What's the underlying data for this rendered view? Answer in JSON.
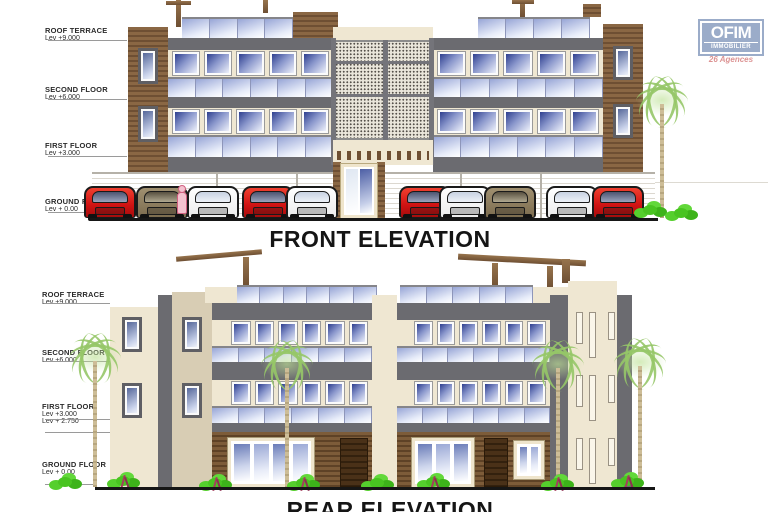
{
  "logo": {
    "name": "OFIM",
    "subtitle": "IMMOBILIER",
    "tagline": "26 Agences"
  },
  "front_elevation": {
    "title": "FRONT ELEVATION",
    "levels": [
      {
        "floor": "ROOF TERRACE",
        "level": "Lev +9.000"
      },
      {
        "floor": "SECOND FLOOR",
        "level": "Lev +6.000"
      },
      {
        "floor": "FIRST FLOOR",
        "level": "Lev +3.000"
      },
      {
        "floor": "GROUND FLOOR",
        "level": "Lev + 0.00"
      }
    ],
    "cars": [
      {
        "color": "red",
        "x": 84
      },
      {
        "color": "brown",
        "x": 136
      },
      {
        "color": "white",
        "x": 187
      },
      {
        "color": "red",
        "x": 242
      },
      {
        "color": "white",
        "x": 286
      },
      {
        "color": "red",
        "x": 399
      },
      {
        "color": "white",
        "x": 439
      },
      {
        "color": "brown",
        "x": 484
      },
      {
        "color": "white",
        "x": 546
      },
      {
        "color": "red",
        "x": 592
      }
    ]
  },
  "rear_elevation": {
    "title": "REAR ELEVATION",
    "levels": [
      {
        "floor": "ROOF TERRACE",
        "level": "Lev +9.000"
      },
      {
        "floor": "SECOND FLOOR",
        "level": "Lev +6.000"
      },
      {
        "floor": "FIRST FLOOR",
        "level": "Lev +3.000",
        "level2": "Lev + 2.750"
      },
      {
        "floor": "GROUND FLOOR",
        "level": "Lev + 0.00"
      }
    ]
  },
  "colors": {
    "facade_gray": "#6b6b70",
    "wood_brown": "#8a6744",
    "cream_wall": "#efe7d2",
    "glass_blue": "#3d52a0",
    "car_red": "#d81f1f",
    "vegetation_green": "#49c421",
    "logo_blue": "#4a6a9d",
    "logo_red": "#c03a3a"
  }
}
